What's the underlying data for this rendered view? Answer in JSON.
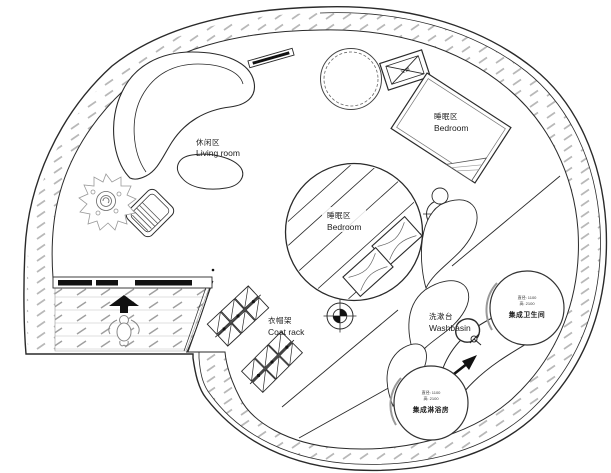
{
  "plan": {
    "areas": {
      "living_room": {
        "zh": "休闲区",
        "en": "Living room"
      },
      "bedroom_upper": {
        "zh": "睡眠区",
        "en": "Bedroom"
      },
      "bedroom_center": {
        "zh": "睡眠区",
        "en": "Bedroom"
      },
      "coat_rack": {
        "zh": "衣帽架",
        "en": "Coat rack"
      },
      "washbasin": {
        "zh": "洗漱台",
        "en": "Washbasin"
      }
    },
    "pods": {
      "bathroom": {
        "dim_diameter": "直径: 1100",
        "dim_height": "高: 2100",
        "name": "集成卫生间"
      },
      "shower": {
        "dim_diameter": "直径: 1100",
        "dim_height": "高: 2100",
        "name": "集成淋浴房"
      }
    },
    "equipment": {
      "ac": "空调"
    },
    "colors": {
      "line": "#2a2a2a",
      "hatch": "#b8b8b8",
      "corridor_line": "#9f9f9f",
      "background": "#ffffff",
      "door_fill": "#111111"
    }
  }
}
